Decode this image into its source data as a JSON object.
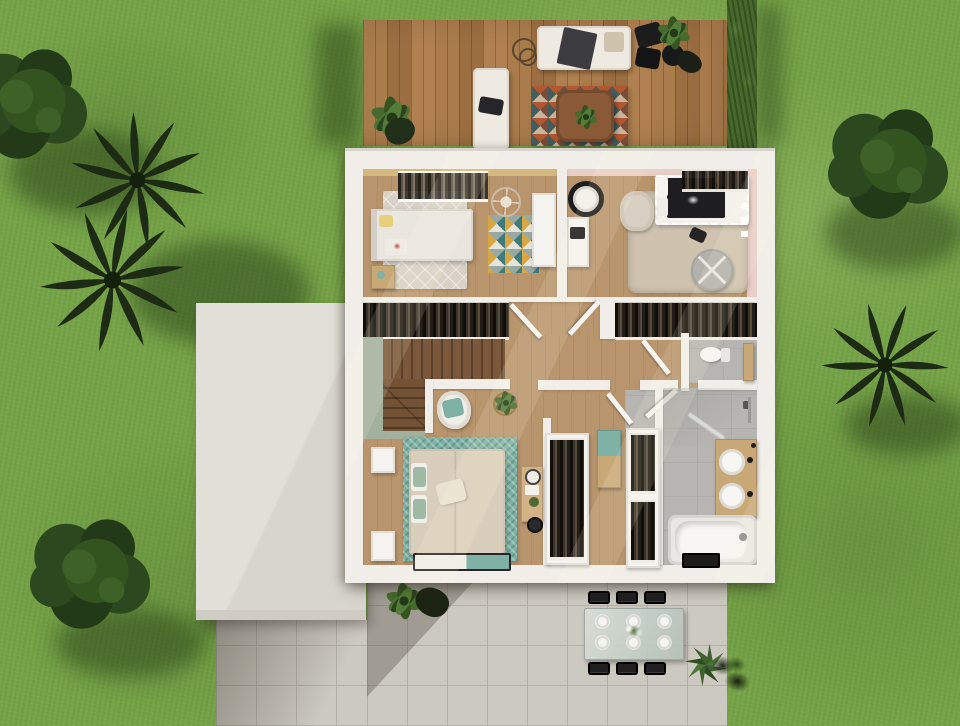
{
  "palette": {
    "grass": "#76a447",
    "grass-d": "#61913a",
    "grass-l": "#8cb657",
    "tree": "#2c481f",
    "tree-d": "#223a18",
    "palm": "#1d2b14",
    "hedge": "#47692c",
    "deck": "#aa7c4c",
    "deck-d": "#8e6138",
    "wall": "#f1eee9",
    "wall-sh": "#c9c5be",
    "roof": "#e2dfd9",
    "wood": "#b8956d",
    "wood-l": "#c9a97f",
    "wood-d": "#a07e58",
    "stair": "#6e4f35",
    "sage": "#a3b09d",
    "rug": "#d8d1c5",
    "ochre": "#d3b97d",
    "pink": "#eacfc8",
    "beige": "#cfc3b0",
    "teal": "#7fb1a4",
    "teal-d": "#558d80",
    "cream": "#d9cebb",
    "tile": "#b6b5b1",
    "vanity": "#c9a878",
    "white": "#f5f3ef",
    "black": "#232220",
    "patio": "#ccc9c0",
    "patio-l": "#b3b0a7",
    "glass": "#c2cac3",
    "mustard": "#d9a740",
    "rust": "#b4562f",
    "navy": "#3f5b5f",
    "wine": "#7a4a3a",
    "sand": "#c8b9a2"
  },
  "garden": {
    "bushes": 3,
    "palms": 3,
    "hedge_rows": 1
  },
  "terrace": {
    "sofas": 2,
    "rugs": 1,
    "coffee_tables": 1,
    "black_chairs": 2,
    "plants": 2,
    "side_tables": 1
  },
  "floor_rooms": [
    {
      "id": "bedroom-1",
      "furniture": [
        "single-bed",
        "open-wardrobe-rack",
        "dresser",
        "round-wire-chair",
        "mosaic-rug",
        "nightstand"
      ]
    },
    {
      "id": "bedroom-2",
      "furniture": [
        "canopy-bed",
        "armchair",
        "round-pouf",
        "area-rug",
        "pendant-lamp",
        "desk"
      ]
    },
    {
      "id": "hallway",
      "furniture": [
        "closet-left",
        "closet-right"
      ]
    },
    {
      "id": "staircase",
      "furniture": []
    },
    {
      "id": "master-bedroom",
      "furniture": [
        "double-bed",
        "nightstand",
        "nightstand",
        "foot-bench",
        "desk",
        "armchair",
        "plant-basket"
      ]
    },
    {
      "id": "walk-in-closet",
      "furniture": [
        "wardrobe-unit",
        "bench",
        "wardrobe-unit"
      ]
    },
    {
      "id": "wc",
      "furniture": [
        "toilet",
        "shelf"
      ]
    },
    {
      "id": "bathroom",
      "furniture": [
        "double-vanity",
        "bathtub",
        "shower",
        "bath-mat"
      ]
    }
  ],
  "patio": {
    "dining_chairs_per_row": 3,
    "chair_rows": 2,
    "place_settings": 6,
    "plants": 2
  }
}
